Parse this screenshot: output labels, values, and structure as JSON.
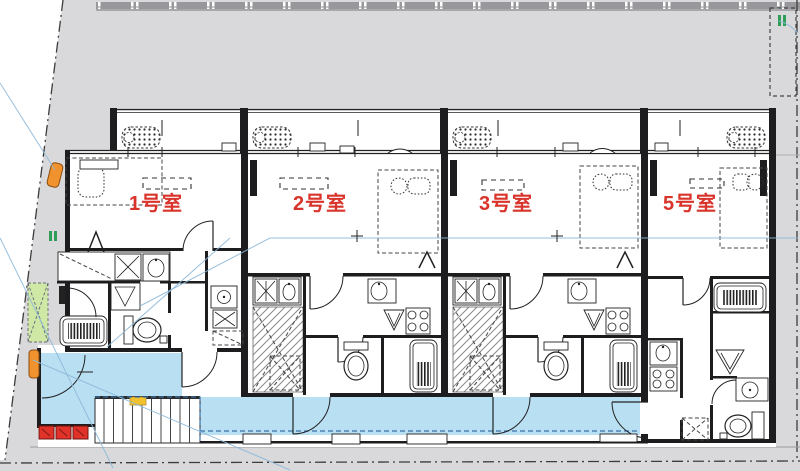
{
  "plan": {
    "rooms": [
      {
        "label": "1号室"
      },
      {
        "label": "2号室"
      },
      {
        "label": "3号室"
      },
      {
        "label": "5号室"
      }
    ]
  },
  "icons": {
    "boundary_marker_icon": "green-double-bar",
    "ac_outdoor_unit_icon": "dashed-dotted-box",
    "bathtub_icon": "rounded-rect-with-comb",
    "toilet_icon": "tank-and-bowl",
    "sink_icon": "square-with-oval",
    "stove_icon": "square-with-burners",
    "shower_icon": "triangle-in-square",
    "stairs_icon": "striped-treads",
    "door_icon": "quarter-arc-swing"
  },
  "colors": {
    "site_gray": "#d9d9db",
    "fence_gray": "#97979c",
    "corridor_blue": "#b9dff2",
    "corridor_dash": "#3a71a8",
    "label_red": "#d9342b",
    "marker_green": "#2e9e57",
    "accent_orange": "#f0922d",
    "alert_red": "#e03228",
    "landscape_green": "#cfe8a6",
    "stair_yellow": "#f2c12e",
    "leader_blue": "#8db8d8",
    "wall_black": "#1d1d1f"
  }
}
